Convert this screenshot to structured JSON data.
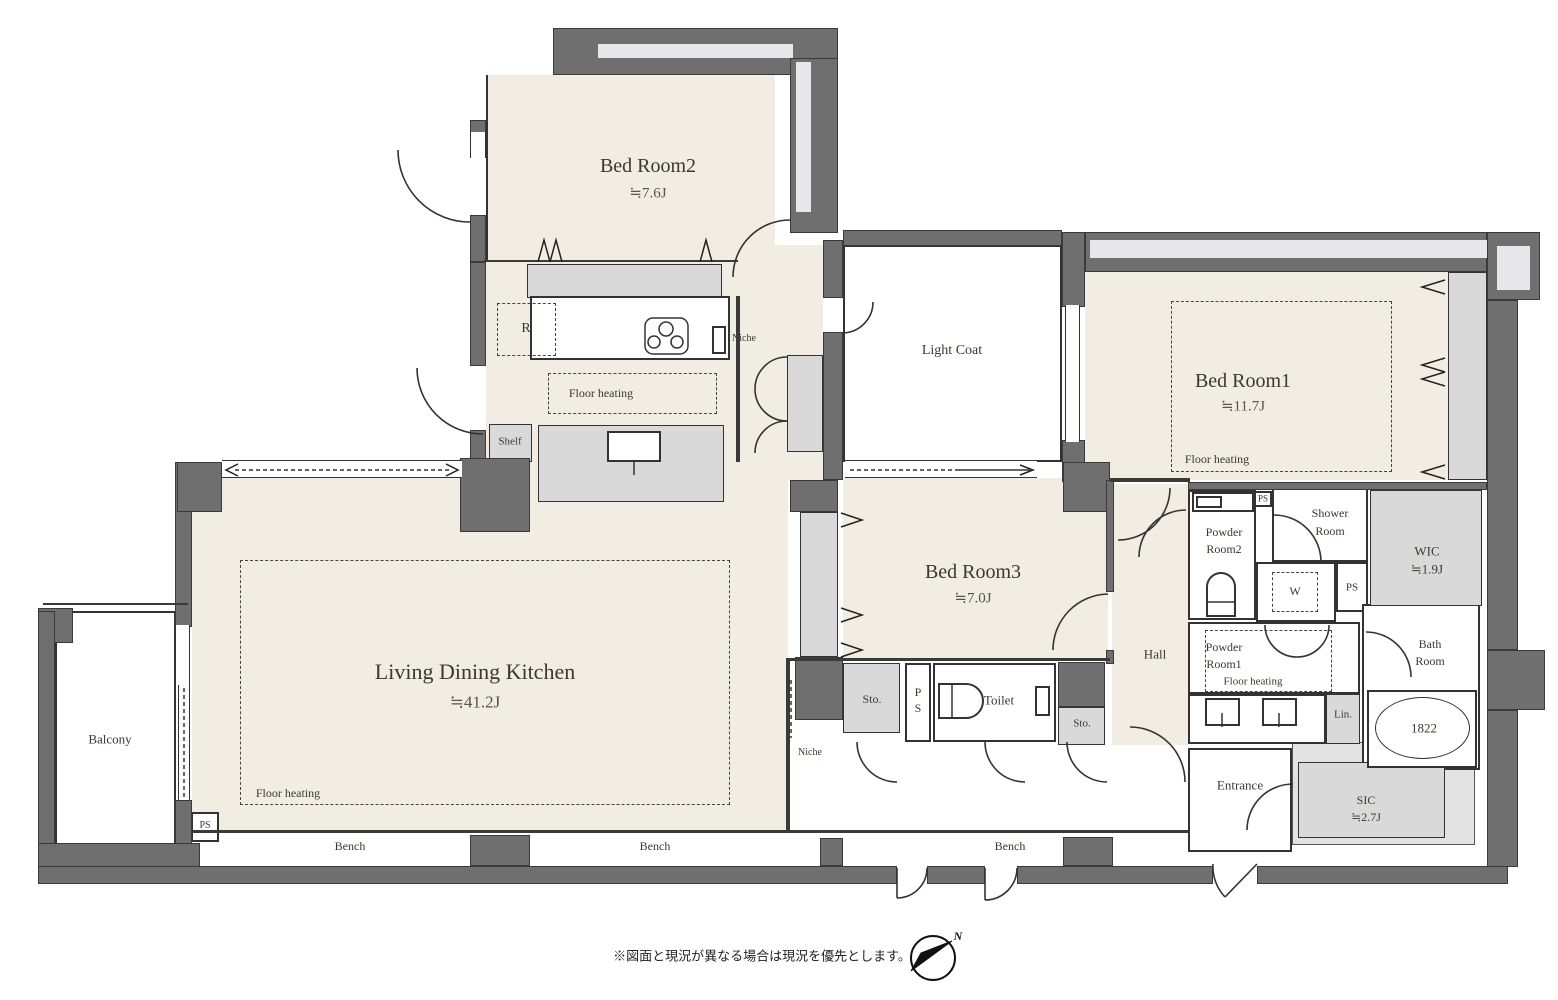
{
  "colors": {
    "wall": "#6f6f6f",
    "floor": "#f2ede3",
    "closet": "#d9d9d9",
    "duct": "#e7e7ea",
    "line": "#333333",
    "paper": "#ffffff"
  },
  "rooms": {
    "bedroom2": {
      "name": "Bed Room2",
      "area": "≒7.6J"
    },
    "bedroom1": {
      "name": "Bed Room1",
      "area": "≒11.7J"
    },
    "bedroom3": {
      "name": "Bed Room3",
      "area": "≒7.0J"
    },
    "ldk": {
      "name": "Living Dining Kitchen",
      "area": "≒41.2J"
    },
    "light_coat": {
      "name": "Light Coat"
    },
    "balcony": {
      "name": "Balcony"
    },
    "hall": {
      "name": "Hall"
    },
    "entrance": {
      "name": "Entrance"
    },
    "toilet": {
      "name": "Toilet"
    },
    "wic": {
      "name": "WIC",
      "area": "≒1.9J"
    },
    "sic": {
      "name": "SIC",
      "area": "≒2.7J"
    },
    "powder_room1": {
      "line1": "Powder",
      "line2": "Room1"
    },
    "powder_room2": {
      "line1": "Powder",
      "line2": "Room2"
    },
    "shower_room": {
      "line1": "Shower",
      "line2": "Room"
    },
    "bath_room": {
      "line1": "Bath",
      "line2": "Room"
    }
  },
  "labels": {
    "floor_heating": "Floor heating",
    "bench": "Bench",
    "niche": "Niche",
    "shelf": "Shelf",
    "storage": "Sto.",
    "pipe_space": "PS",
    "washer": "W",
    "refrigerator": "R",
    "linen": "Lin.",
    "bathtub_size": "1822",
    "north": "N"
  },
  "caption": "※図面と現況が異なる場合は現況を優先とします。"
}
